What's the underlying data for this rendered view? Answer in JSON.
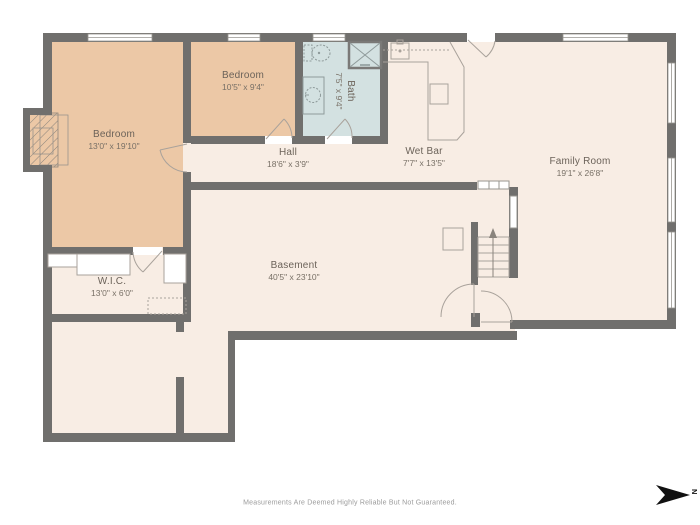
{
  "rooms": {
    "bedroom1": {
      "name": "Bedroom",
      "dims": "13'0\" x 19'10\""
    },
    "bedroom2": {
      "name": "Bedroom",
      "dims": "10'5\" x 9'4\""
    },
    "bath": {
      "name": "Bath",
      "dims": "7'5\" x 9'4\""
    },
    "hall": {
      "name": "Hall",
      "dims": "18'6\" x 3'9\""
    },
    "wet_bar": {
      "name": "Wet Bar",
      "dims": "7'7\" x 13'5\""
    },
    "family_room": {
      "name": "Family Room",
      "dims": "19'1\" x 26'8\""
    },
    "basement": {
      "name": "Basement",
      "dims": "40'5\" x 23'10\""
    },
    "wic": {
      "name": "W.I.C.",
      "dims": "13'0\" x 6'0\""
    }
  },
  "footer": {
    "disclaimer": "Measurements Are Deemed Highly Reliable But Not Guaranteed."
  },
  "compass": {
    "label": "N"
  },
  "colors": {
    "wall": "#706f6d",
    "bedroom_fill": "#ecc8a6",
    "bath_fill": "#d3e1e1",
    "floor_fill": "#f8ede4",
    "fixture_line": "#a9a29b",
    "background": "#ffffff"
  }
}
